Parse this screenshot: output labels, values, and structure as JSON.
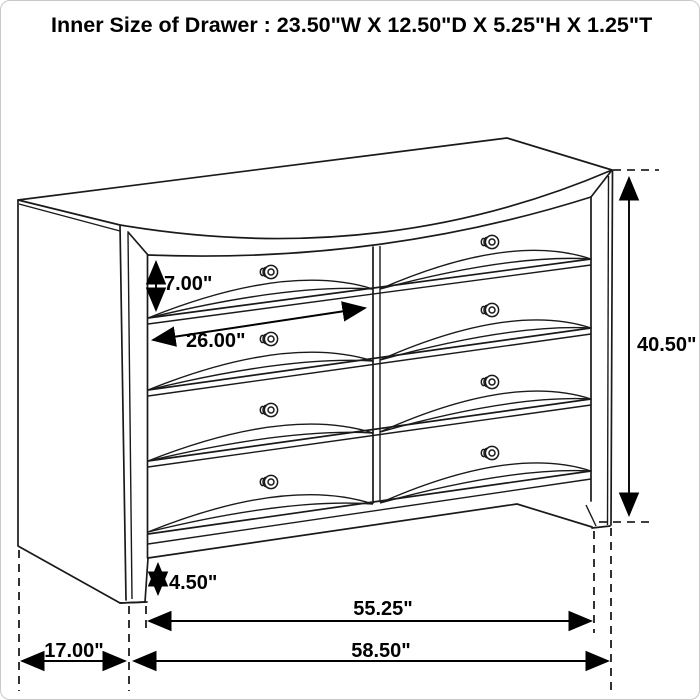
{
  "page": {
    "background": "#ffffff",
    "border_color": "#c9c9c9",
    "line_color": "#1a1a1a"
  },
  "title": "Inner Size of Drawer : 23.50\"W X 12.50\"D X 5.25\"H X 1.25\"T",
  "drawing": {
    "subject": "8-drawer dresser perspective line drawing",
    "drawer_rows": 4,
    "drawer_columns": 2,
    "knob_count": 8
  },
  "dimension_labels": {
    "drawer_front_height": "7.00\"",
    "drawer_opening_width": "26.00\"",
    "overall_height": "40.50\"",
    "base_height": "4.50\"",
    "front_width": "55.25\"",
    "overall_width": "58.50\"",
    "side_depth": "17.00\""
  }
}
